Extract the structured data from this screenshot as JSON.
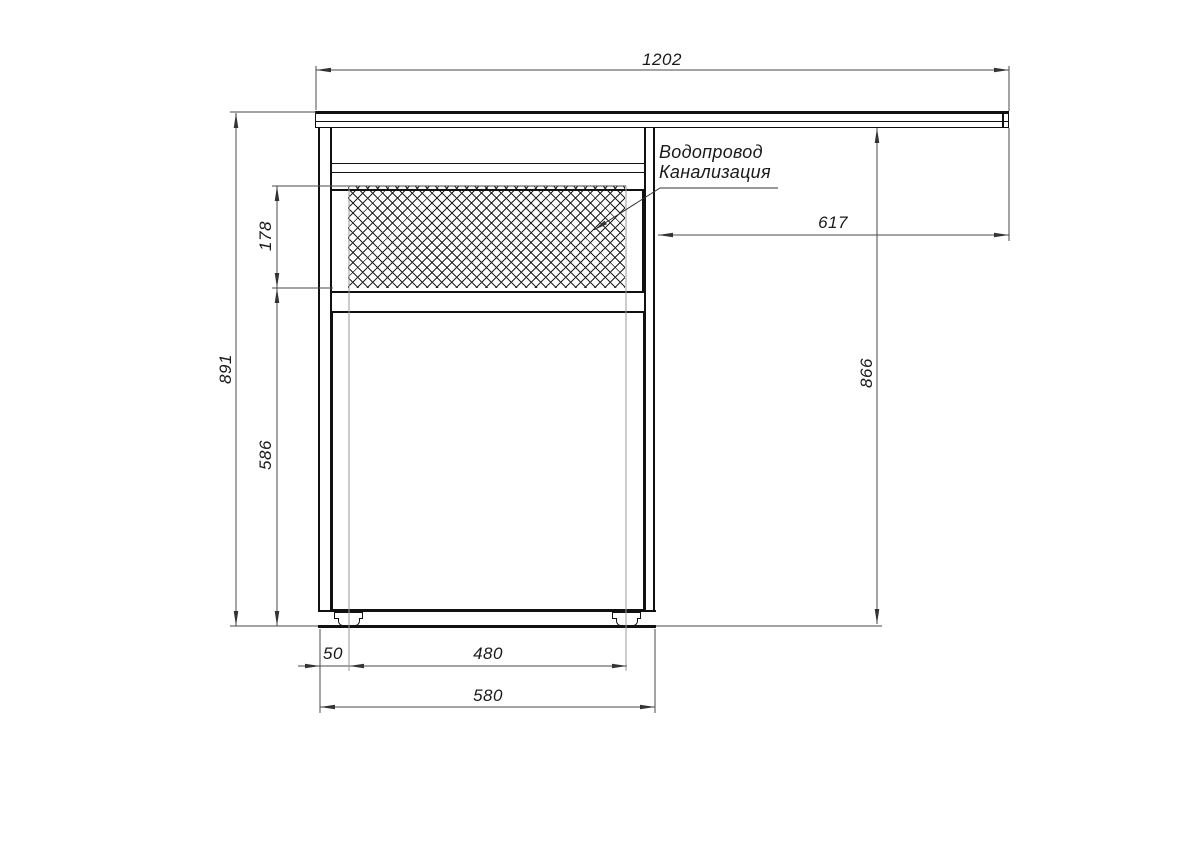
{
  "drawing": {
    "annotation": {
      "line1": "Водопровод",
      "line2": "Канализация"
    },
    "dimensions": {
      "countertop_width": "1202",
      "total_height": "891",
      "service_zone_height": "178",
      "lower_section_height": "586",
      "countertop_right_span": "617",
      "body_height": "866",
      "foot_inset": "50",
      "feet_span": "480",
      "cabinet_width": "580"
    },
    "colors": {
      "object_line": "#111111",
      "dimension_line": "#4a4a4a",
      "light_extension_line": "#9a9a9a",
      "background": "#ffffff"
    }
  }
}
